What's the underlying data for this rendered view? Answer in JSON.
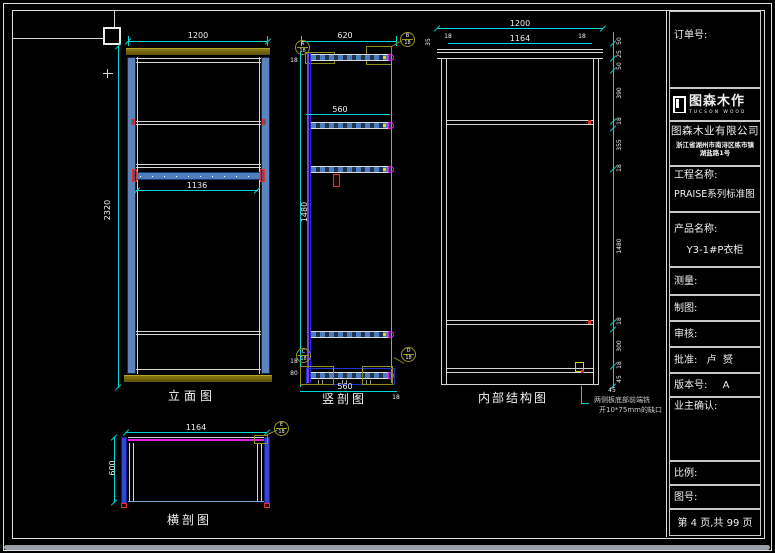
{
  "colors": {
    "dim_line": "#00d8d8",
    "dim_text": "#efefef",
    "panel_blue": "#5b84bd",
    "wood_olive": "#6e5f06",
    "back_magenta": "#dd22dd",
    "back_purple": "#7a3fd6",
    "accent_red": "#e03030",
    "callout_olive": "#9a9a20"
  },
  "views": {
    "elevation": {
      "label": "立面图",
      "dim_width": "1200",
      "dim_rod_width": "1136",
      "dim_height": "2320"
    },
    "vsection": {
      "label": "竖剖图",
      "dim_depth": "620",
      "dim_shelf_depth": "560",
      "dim_bottom_depth": "560",
      "dim_back_gap": "18",
      "dim_hang_height": "1480",
      "dim_base_18": "18",
      "dim_base_80": "80",
      "dim_corner_18": "18",
      "callout_a": "A",
      "callout_b": "B",
      "callout_c": "C",
      "callout_d": "D",
      "callout_sheet": "18"
    },
    "internal": {
      "label": "内部结构图",
      "dim_width": "1200",
      "dim_inner_width": "1164",
      "dim_side_left": "18",
      "dim_side_right": "18",
      "dim_top_left": "35",
      "dim_note": "45",
      "chain": [
        "50",
        "25",
        "50",
        "390",
        "18",
        "355",
        "18",
        "1480",
        "18",
        "300",
        "18",
        "45"
      ]
    },
    "hsection": {
      "label": "横剖图",
      "dim_width": "1164",
      "dim_depth": "600",
      "callout_e": "E",
      "callout_sheet": "18"
    },
    "note": {
      "line1": "两侧板底部前端铣",
      "line2": "开10*75mm的缺口"
    }
  },
  "titleblock": {
    "order_label": "订单号:",
    "logo_name": "图森木作",
    "logo_sub": "TUCSON WOOD",
    "company": "图森木业有限公司",
    "address_line1": "浙江省湖州市南浔区练市镇",
    "address_line2": "湖盐路1号",
    "project_label": "工程名称:",
    "project_value": "PRAISE系列标准图",
    "product_label": "产品名称:",
    "product_value": "Y3-1#P衣柜",
    "measure_label": "测量:",
    "draft_label": "制图:",
    "review_label": "审核:",
    "approve_label": "批准:",
    "approve_value": "卢  赟",
    "version_label": "版本号:",
    "version_value": "A",
    "owner_label": "业主确认:",
    "scale_label": "比例:",
    "number_label": "图号:",
    "page_text": "第 4 页,共 99 页"
  }
}
